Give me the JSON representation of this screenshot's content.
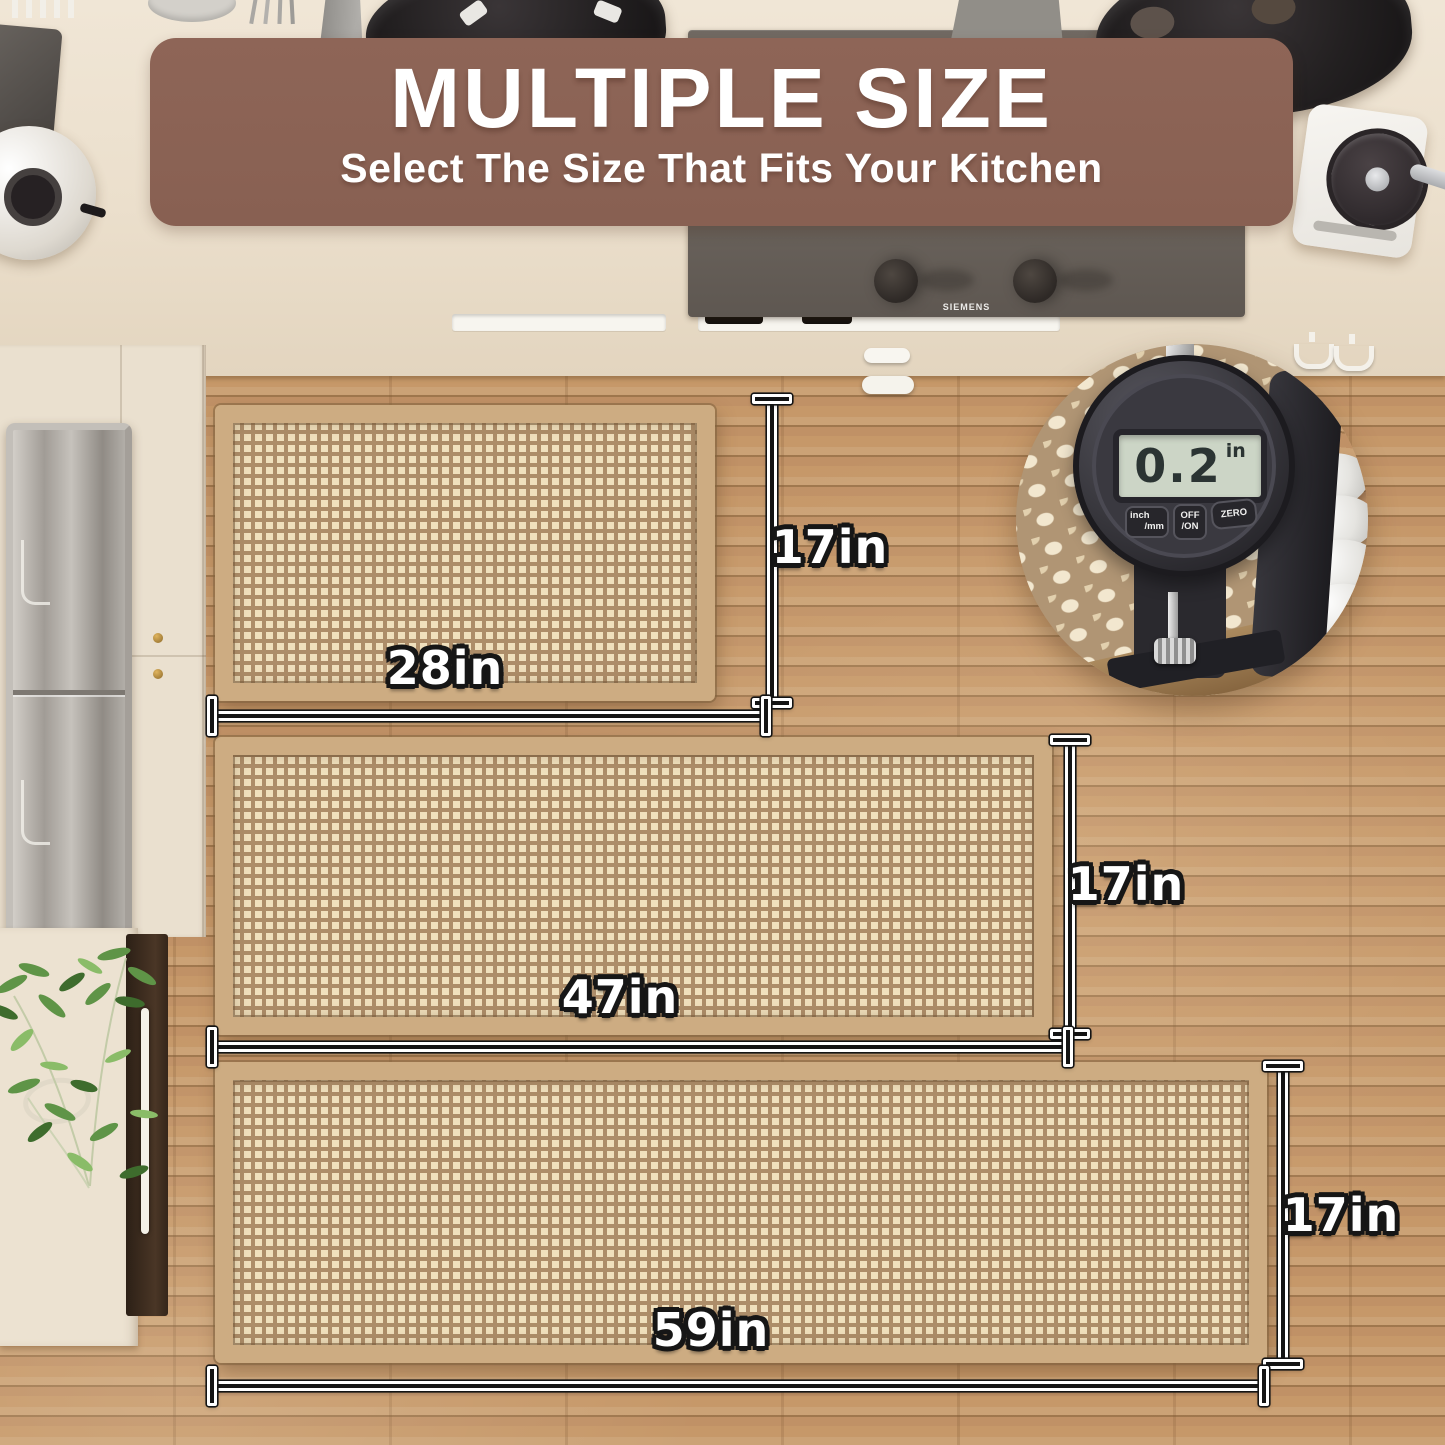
{
  "banner": {
    "title": "MULTIPLE SIZE",
    "subtitle": "Select The Size That Fits Your Kitchen"
  },
  "appliances": {
    "stove_brand": "SIEMENS"
  },
  "inset": {
    "reading": "0.2",
    "unit": "in",
    "buttons": [
      {
        "line1": "inch",
        "line2": "/mm"
      },
      {
        "line1": "OFF",
        "line2": "/ON"
      },
      {
        "line1": "ZERO",
        "line2": ""
      }
    ]
  },
  "mats": [
    {
      "id": "small",
      "width_label": "28in",
      "height_label": "17in"
    },
    {
      "id": "medium",
      "width_label": "47in",
      "height_label": "17in"
    },
    {
      "id": "large",
      "width_label": "59in",
      "height_label": "17in"
    }
  ],
  "colors": {
    "banner_bg": "#8a6254",
    "label_text": "#ffffff",
    "label_outline": "#161616",
    "mat_border": "#cdac82",
    "mat_square": "#f0e0bd",
    "mat_ground": "#ad8d69",
    "floor": "#c79a6b",
    "counter": "#ebdfcc",
    "stove": "#6b645d",
    "lcd_bg": "#ccd5c6",
    "lcd_text": "#2b3433"
  }
}
